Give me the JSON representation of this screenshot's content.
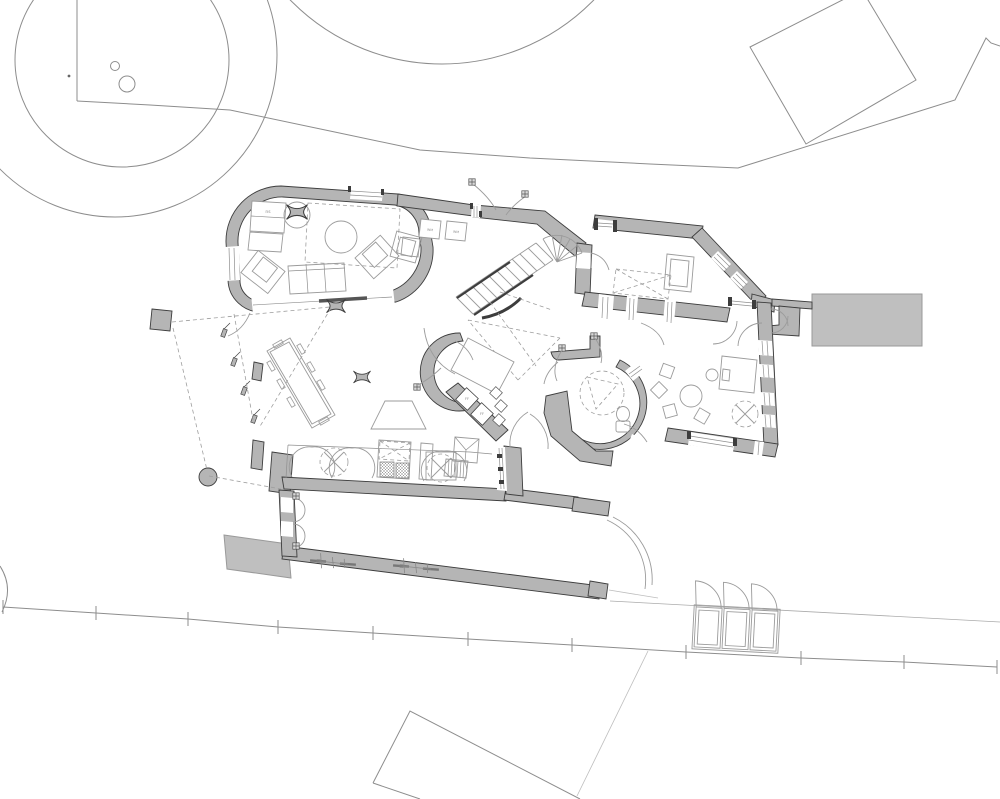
{
  "drawing": {
    "type": "architectural-floor-plan",
    "labels": {
      "side_table": "ns",
      "washer_a": "WM",
      "washer_b": "WM",
      "shelf_a": "FF",
      "shelf_b": "FF"
    },
    "colors": {
      "background": "#ffffff",
      "wall_fill": "#b5b5b5",
      "wall_outline": "#3d3d3d",
      "slab_fill": "#bfbfbf",
      "site_line": "#8d8d8d",
      "furniture_line": "#9b9b9b"
    }
  }
}
